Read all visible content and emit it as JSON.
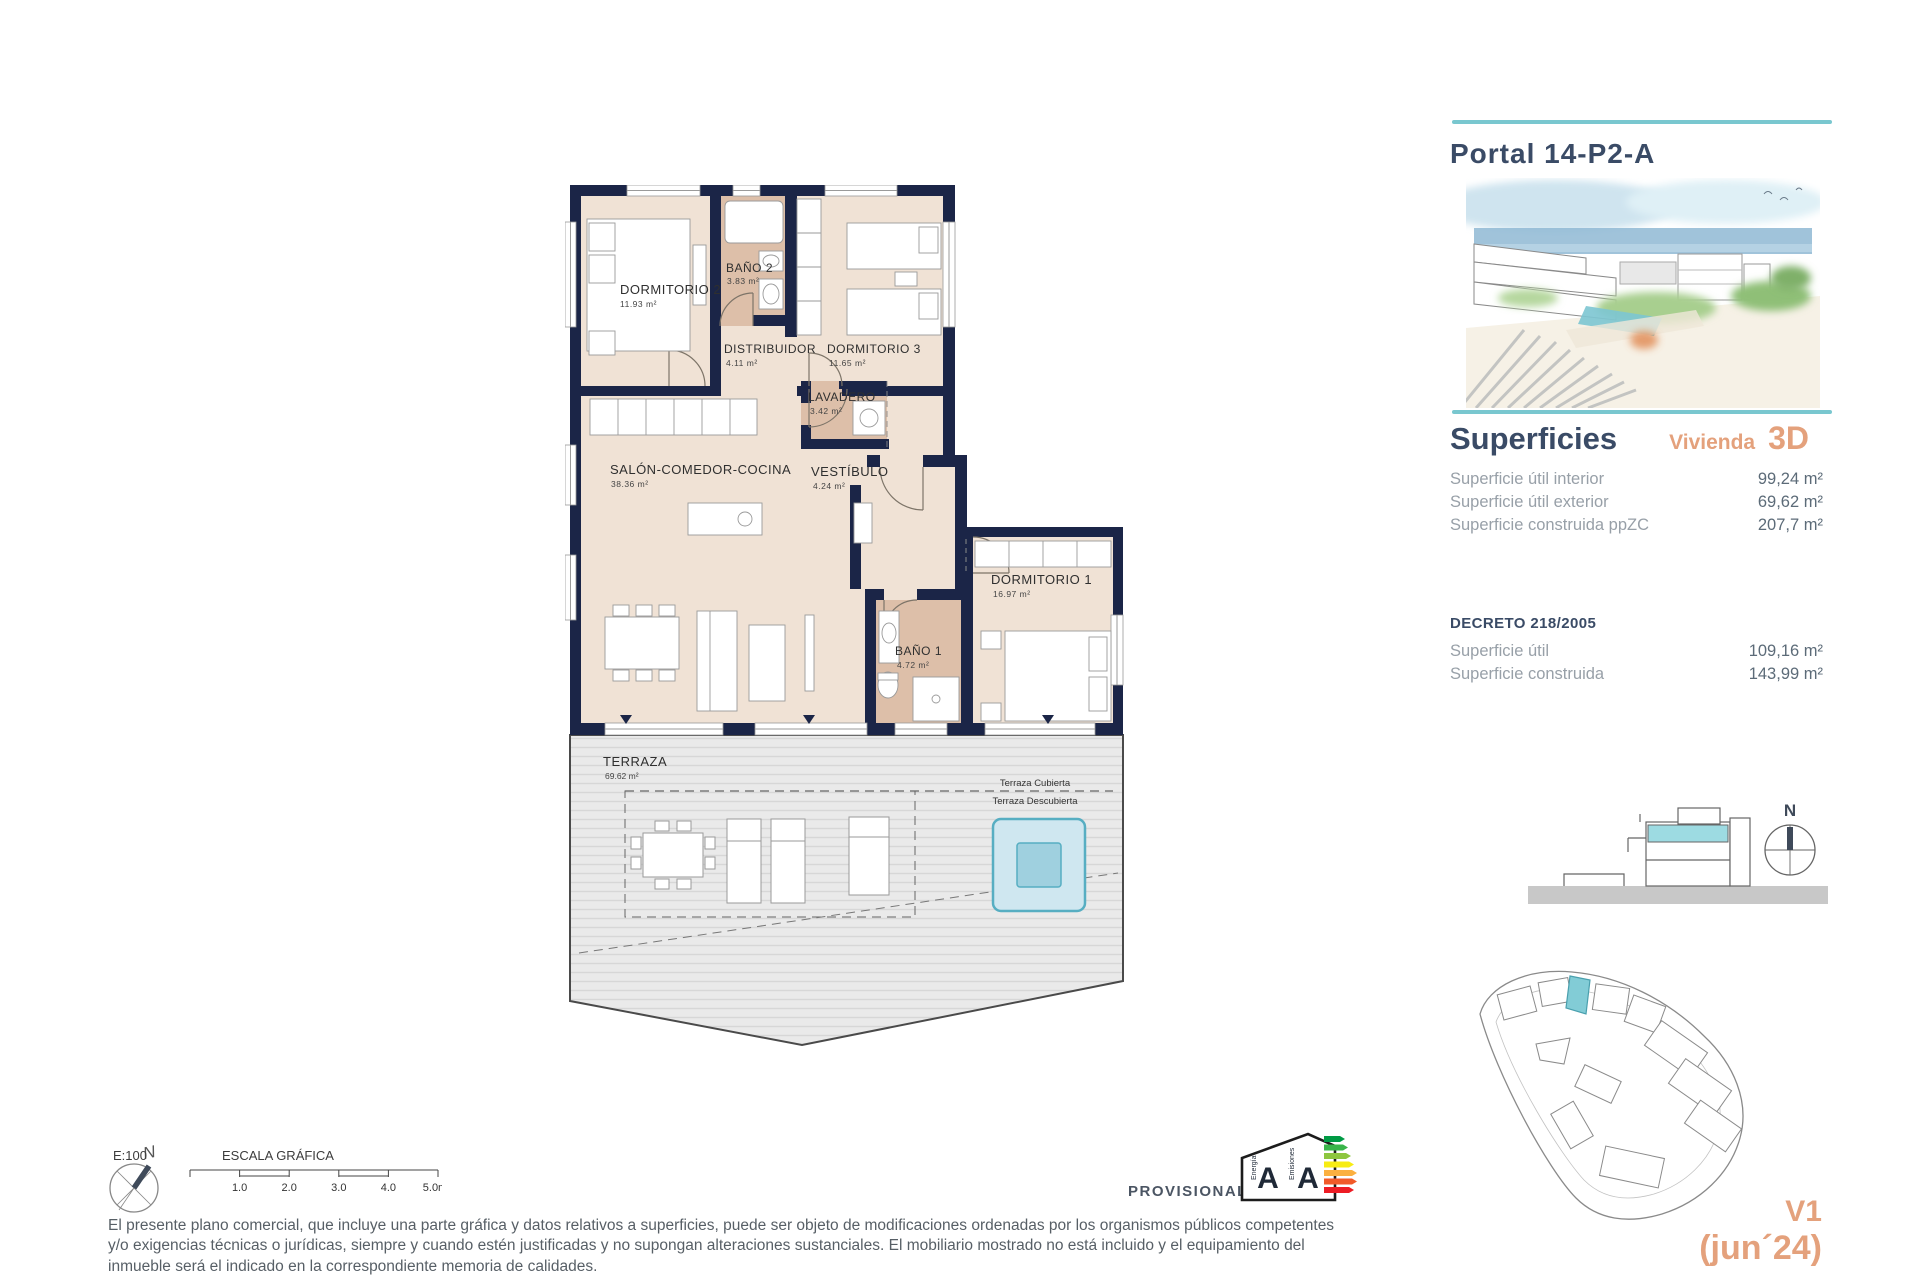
{
  "header": {
    "title": "Portal 14-P2-A"
  },
  "superficies": {
    "heading": "Superficies",
    "vivienda_label": "Vivienda",
    "vivienda_type": "3D",
    "rows": [
      {
        "label": "Superficie útil interior",
        "value": "99,24 m²"
      },
      {
        "label": "Superficie útil exterior",
        "value": "69,62 m²"
      },
      {
        "label": "Superficie construida ppZC",
        "value": "207,7 m²"
      }
    ],
    "decreto": {
      "heading": "DECRETO 218/2005",
      "rows": [
        {
          "label": "Superficie útil",
          "value": "109,16 m²"
        },
        {
          "label": "Superficie construida",
          "value": "143,99 m²"
        }
      ]
    }
  },
  "floorplan": {
    "rooms": [
      {
        "name": "DORMITORIO 2",
        "area": "11.93 m²"
      },
      {
        "name": "BAÑO 2",
        "area": "3.83 m²"
      },
      {
        "name": "DISTRIBUIDOR",
        "area": "4.11 m²"
      },
      {
        "name": "DORMITORIO 3",
        "area": "11.65 m²"
      },
      {
        "name": "LAVADERO",
        "area": "3.42 m²"
      },
      {
        "name": "SALÓN-COMEDOR-COCINA",
        "area": "38.36 m²"
      },
      {
        "name": "VESTÍBULO",
        "area": "4.24 m²"
      },
      {
        "name": "DORMITORIO 1",
        "area": "16.97 m²"
      },
      {
        "name": "BAÑO 1",
        "area": "4.72 m²"
      },
      {
        "name": "TERRAZA",
        "area": "69.62 m²"
      }
    ],
    "terrace_labels": {
      "covered": "Terraza Cubierta",
      "uncovered": "Terraza Descubierta"
    }
  },
  "footer": {
    "scale_ratio": "E:100",
    "scale_title": "ESCALA GRÁFICA",
    "scale_ticks": [
      "1.0",
      "2.0",
      "3.0",
      "4.0",
      "5.0m"
    ],
    "provisional": "PROVISIONAL",
    "north_label": "N",
    "disclaimer": "El presente plano comercial, que incluye una parte gráfica y datos relativos a superficies, puede ser objeto de modificaciones ordenadas por los organismos públicos competentes y/o exigencias técnicas o jurídicas, siempre y cuando estén justificadas y no supongan alteraciones sustanciales. El mobiliario mostrado no está incluido y el equipamiento del inmueble será el indicado en la correspondiente memoria de calidades."
  },
  "energy_label": {
    "letters": [
      "A",
      "A"
    ],
    "scales": [
      "Energía",
      "Emisiones"
    ]
  },
  "version": {
    "line1": "V1",
    "line2": "(jun´24)"
  },
  "colors": {
    "wall": "#1b2547",
    "room": "#f0e2d5",
    "wet_room": "#ddbfa9",
    "teal": "#79c7cf",
    "orange": "#e4a17c",
    "navy_text": "#3a4b66",
    "pool": "#9fd0df"
  }
}
